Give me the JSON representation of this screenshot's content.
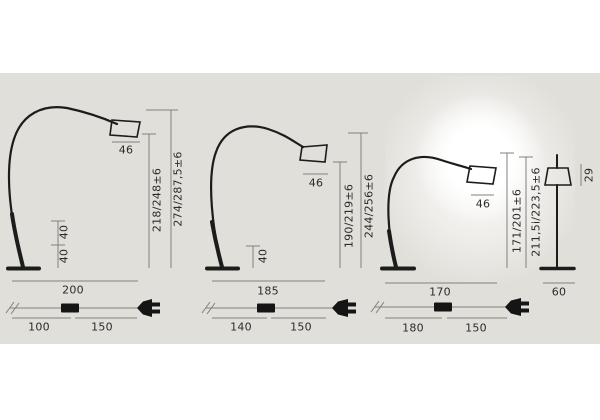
{
  "diagram_title": "arc floor lamp dimension drawing",
  "colors": {
    "page_bg": "#ffffff",
    "panel_bg": "#e1dfd9",
    "drawing_line": "#1c1c1c",
    "dimension_line": "#82807a",
    "label_text": "#2b2b2b",
    "glow": "#ffffff"
  },
  "lamps": [
    {
      "variant": "arc-lamp-large",
      "shade_diameter": "46",
      "height_inner": "218/248±6",
      "height_overall": "274/287,5±6",
      "stem_seg_1": "40",
      "stem_seg_2": "40",
      "base_depth": "200",
      "cable_seg_1": "100",
      "cable_seg_2": "150"
    },
    {
      "variant": "arc-lamp-medium",
      "shade_diameter": "46",
      "height_inner": "190/219±6",
      "height_overall": "244/256±6",
      "stem_seg_1": "40",
      "base_depth": "185",
      "cable_seg_1": "140",
      "cable_seg_2": "150"
    },
    {
      "variant": "arc-lamp-small-lit",
      "shade_diameter": "46",
      "height_inner": "171/201±6",
      "height_overall": "211,5i/223,5±6",
      "base_depth": "170",
      "cable_seg_1": "180",
      "cable_seg_2": "150"
    },
    {
      "variant": "straight-lamp",
      "shade_height": "29",
      "base_width": "60"
    }
  ]
}
